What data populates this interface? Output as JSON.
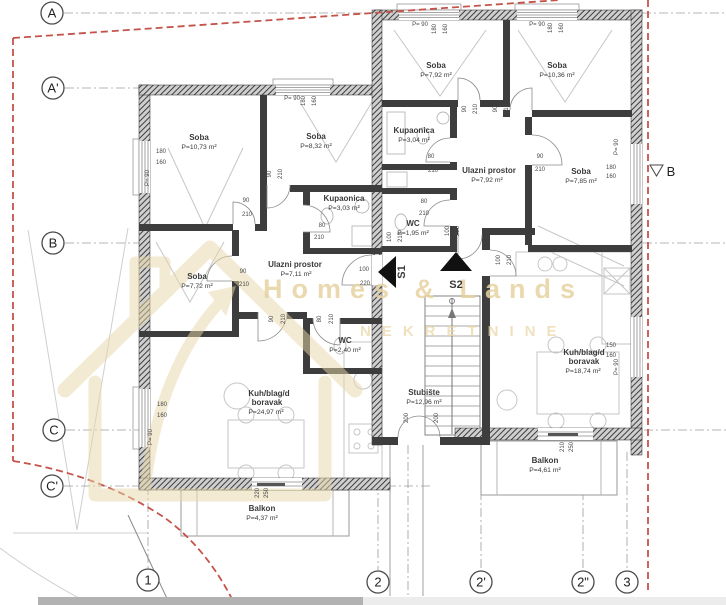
{
  "plan_title": "Floor plan",
  "watermark": {
    "brand": "Homes & Lands",
    "subtitle": "NEKRETNINE"
  },
  "grid_rows": [
    "A",
    "A'",
    "B",
    "C",
    "C'"
  ],
  "grid_cols": [
    "1",
    "2",
    "2'",
    "2\"",
    "3"
  ],
  "section_marker": "B",
  "stair_markers": {
    "s1": "S1",
    "s2": "S2"
  },
  "rooms": [
    {
      "name": "Soba",
      "area": "P=10,73 m²"
    },
    {
      "name": "Soba",
      "area": "P=8,32 m²"
    },
    {
      "name": "Kupaonica",
      "area": "P=3,03 m²"
    },
    {
      "name": "Soba",
      "area": "P=7,72 m²"
    },
    {
      "name": "Ulazni prostor",
      "area": "P=7,11 m²"
    },
    {
      "name": "WC",
      "area": "P=2,40 m²"
    },
    {
      "name": "Kuh/blag/d",
      "name2": "boravak",
      "area": "P=24,97 m²"
    },
    {
      "name": "Balkon",
      "area": "P=4,37 m²"
    },
    {
      "name": "Soba",
      "area": "P=7,92 m²"
    },
    {
      "name": "Soba",
      "area": "P=10,36 m²"
    },
    {
      "name": "Kupaonica",
      "area": "P=3,04 m²"
    },
    {
      "name": "Ulazni prostor",
      "area": "P=7,92 m²"
    },
    {
      "name": "WC",
      "area": "P=1,95 m²"
    },
    {
      "name": "Soba",
      "area": "P=7,85 m²"
    },
    {
      "name": "Kuh/blag/d",
      "name2": "boravak",
      "area": "P=18,74 m²"
    },
    {
      "name": "Stubište",
      "area": "P=12,96 m²"
    },
    {
      "name": "Balkon",
      "area": "P=4,61 m²"
    }
  ],
  "dims": [
    "180",
    "160",
    "P= 90",
    "P= 90",
    "180",
    "160",
    "90",
    "210",
    "90",
    "210",
    "80",
    "210",
    "90",
    "210",
    "100",
    "220",
    "90",
    "210",
    "80",
    "210",
    "180",
    "160",
    "P= 90",
    "220",
    "250",
    "P= 90",
    "180",
    "160",
    "P= 90",
    "180",
    "160",
    "90",
    "210",
    "90",
    "210",
    "80",
    "210",
    "90",
    "210",
    "80",
    "210",
    "100",
    "220",
    "100",
    "210",
    "100",
    "210",
    "P= 90",
    "180",
    "160",
    "150",
    "160",
    "P= 90",
    "210",
    "250",
    "200",
    "200"
  ],
  "colors": {
    "boundary_red": "#c4534a",
    "watermark_tan": "#e7d2a0",
    "wall_dark": "#3d3d3d"
  }
}
